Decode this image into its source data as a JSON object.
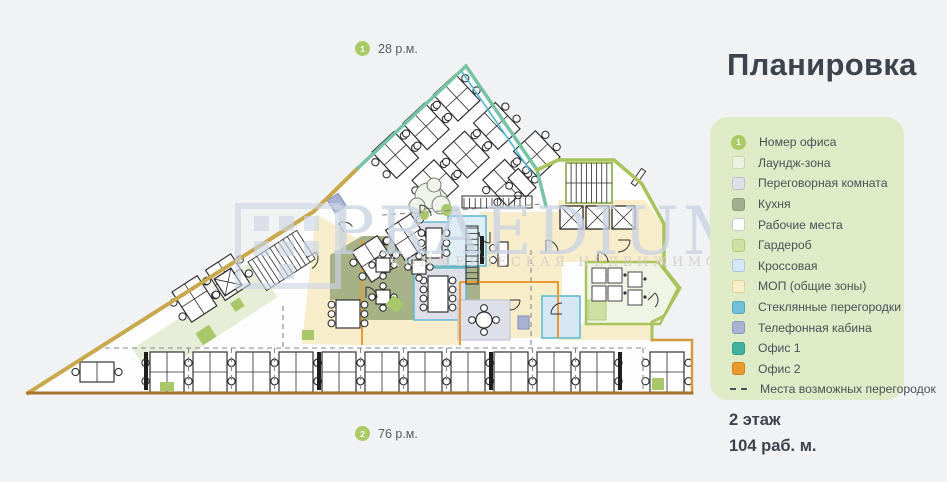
{
  "title": "Планировка",
  "watermark": {
    "brand": "PRAEDIUM",
    "subtitle": "КОММЕРЧЕСКАЯ НЕДВИЖИМОСТЬ"
  },
  "markers": {
    "top": {
      "number": "1",
      "label": "28 р.м."
    },
    "bottom": {
      "number": "2",
      "label": "76 р.м."
    }
  },
  "legend": {
    "items": [
      {
        "swatch": "badge",
        "badge": "1",
        "label": "Номер офиса",
        "color": "#a9cb66"
      },
      {
        "swatch": "square",
        "label": "Лаундж-зона",
        "color": "#edf2e0",
        "border": "#cbd7af"
      },
      {
        "swatch": "square",
        "label": "Переговорная комната",
        "color": "#dfe1e9",
        "border": "#bcc0cf"
      },
      {
        "swatch": "square",
        "label": "Кухня",
        "color": "#a3ad90",
        "border": "#8e9a7a"
      },
      {
        "swatch": "square",
        "label": "Рабочие места",
        "color": "#ffffff",
        "border": "#c6ccd2"
      },
      {
        "swatch": "square",
        "label": "Гардероб",
        "color": "#cfe0a4",
        "border": "#b2cb7d"
      },
      {
        "swatch": "square",
        "label": "Кроссовая",
        "color": "#d5e7f3",
        "border": "#a9c8de"
      },
      {
        "swatch": "square",
        "label": "МОП (общие зоны)",
        "color": "#f9eeca",
        "border": "#e2d092"
      },
      {
        "swatch": "square",
        "label": "Стеклянные перегородки",
        "color": "#71c0d8",
        "border": "#4ba6c1"
      },
      {
        "swatch": "square",
        "label": "Телефонная кабина",
        "color": "#a8b3d3",
        "border": "#8b97bf"
      },
      {
        "swatch": "square",
        "label": "Офис 1",
        "color": "#42b2a0",
        "border": "#2f9c8b"
      },
      {
        "swatch": "square",
        "label": "Офис 2",
        "color": "#e9992e",
        "border": "#d0821a"
      },
      {
        "swatch": "dash",
        "label": "Места возможных перегородок",
        "color": "#4a4f55"
      }
    ]
  },
  "footer": {
    "floor": "2 этаж",
    "workplaces": "104 раб. м."
  },
  "colors": {
    "accent_green": "#a9cb66",
    "panel_bg": "#dfeac6",
    "title_text": "#3d444d",
    "wall_tan": "#c9a94e",
    "wall_orange": "#a8742b",
    "wall_green": "#a9c35d",
    "glass_teal": "#58b7d2",
    "office2_orange": "#e9992e",
    "kitchen_olive": "#9fab80",
    "mop_cream": "#f7edca",
    "watermark_blue": "#c9d3e3"
  }
}
